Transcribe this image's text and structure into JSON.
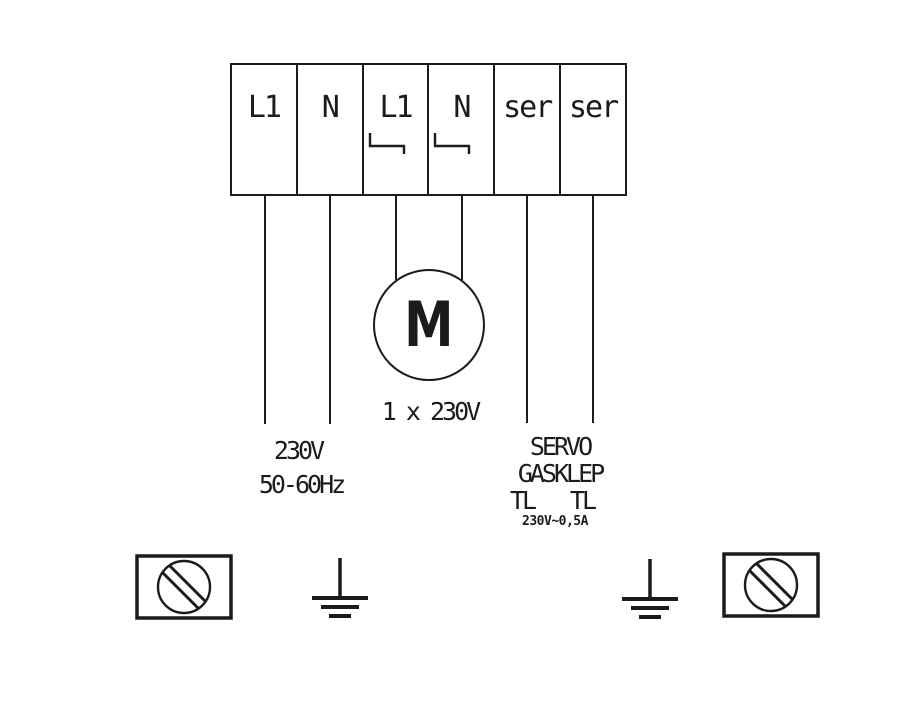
{
  "terminals": [
    {
      "label": "L1",
      "bracket": false
    },
    {
      "label": "N",
      "bracket": false
    },
    {
      "label": "L1",
      "bracket": true
    },
    {
      "label": "N",
      "bracket": true
    },
    {
      "label": "ser",
      "bracket": false
    },
    {
      "label": "ser",
      "bracket": false
    }
  ],
  "motor": {
    "letter": "M",
    "rating": "1 x 230V"
  },
  "mains": {
    "voltage": "230V",
    "frequency": "50-60Hz"
  },
  "servo": {
    "name": "SERVO",
    "device": "GASKLEP",
    "tl_left": "TL",
    "tl_right": "TL",
    "rating": "230V~0,5A"
  },
  "icons": {
    "jumper_bracket": "jumper-bracket-icon",
    "slotted_screw": "slotted-screw-icon",
    "earth_ground": "earth-ground-icon"
  },
  "colors": {
    "ink": "#1b1b1b",
    "background": "#ffffff"
  }
}
